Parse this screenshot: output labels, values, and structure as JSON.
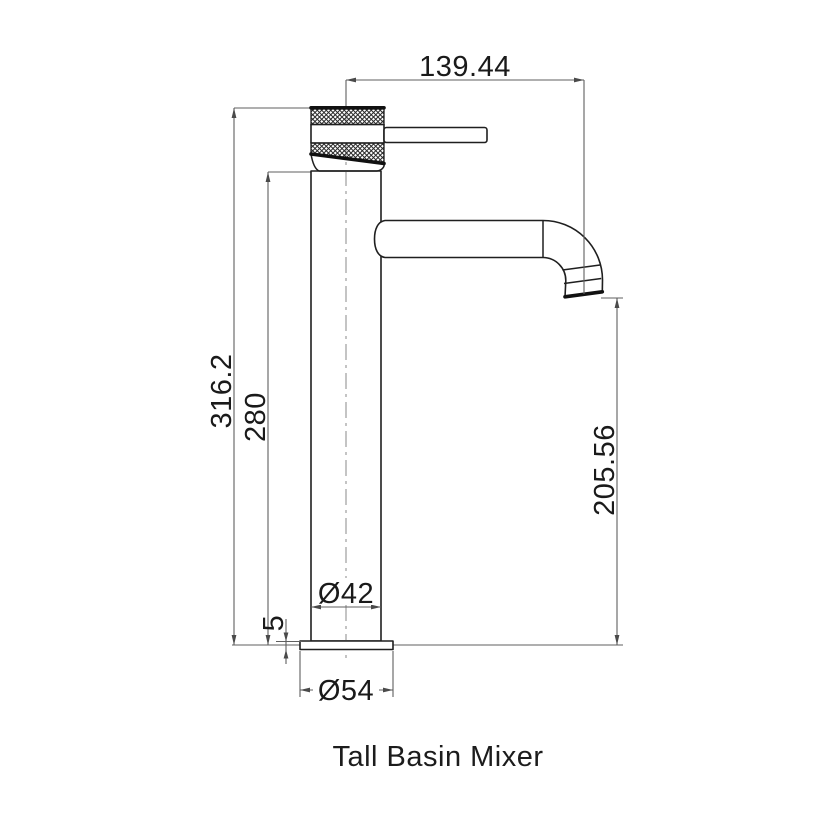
{
  "drawing": {
    "caption": "Tall Basin Mixer",
    "dimensions": {
      "spout_reach": "139.44",
      "overall_height": "316.2",
      "height_to_spout": "280",
      "outlet_height": "205.56",
      "body_diameter": "Ø42",
      "base_thickness": "5",
      "base_diameter": "Ø54"
    }
  }
}
